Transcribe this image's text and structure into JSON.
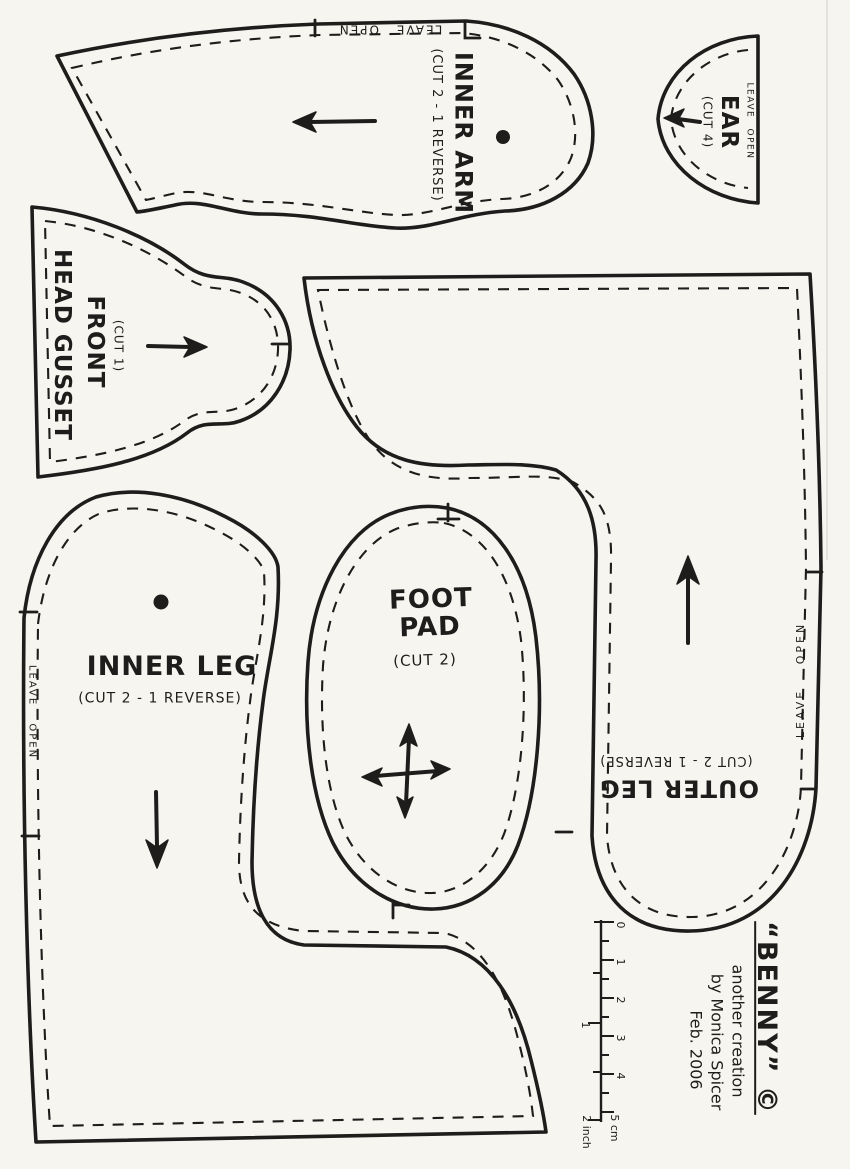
{
  "pieces": {
    "inner_arm": {
      "name": "INNER ARM",
      "cut": "(CUT 2 - 1 REVERSE)",
      "leave_open": "LEAVE OPEN"
    },
    "ear": {
      "name": "EAR",
      "cut": "(CUT 4)",
      "leave_open": "LEAVE OPEN"
    },
    "head_gusset": {
      "name_line1": "HEAD GUSSET",
      "name_line2": "FRONT",
      "cut": "(CUT 1)"
    },
    "outer_leg": {
      "name": "OUTER LEG",
      "cut": "(CUT 2 - 1 REVERSE)",
      "leave_open": "LEAVE OPEN"
    },
    "inner_leg": {
      "name": "INNER LEG",
      "cut": "(CUT 2 - 1 REVERSE)",
      "leave_open": "LEAVE OPEN"
    },
    "foot_pad": {
      "name_line1": "FOOT",
      "name_line2": "PAD",
      "cut": "(CUT 2)"
    }
  },
  "ruler": {
    "cm": [
      "0",
      "1",
      "2",
      "3",
      "4"
    ],
    "cm_end": "5 cm",
    "inch_mid": "1",
    "inch_end": "2 inch"
  },
  "credits": {
    "title": "“BENNY” ©",
    "line1": "another creation",
    "line2": "by Monica Spicer",
    "line3": "Feb. 2006"
  },
  "colors": {
    "ink": "#1e1d1b",
    "paper": "#f6f5f0"
  }
}
